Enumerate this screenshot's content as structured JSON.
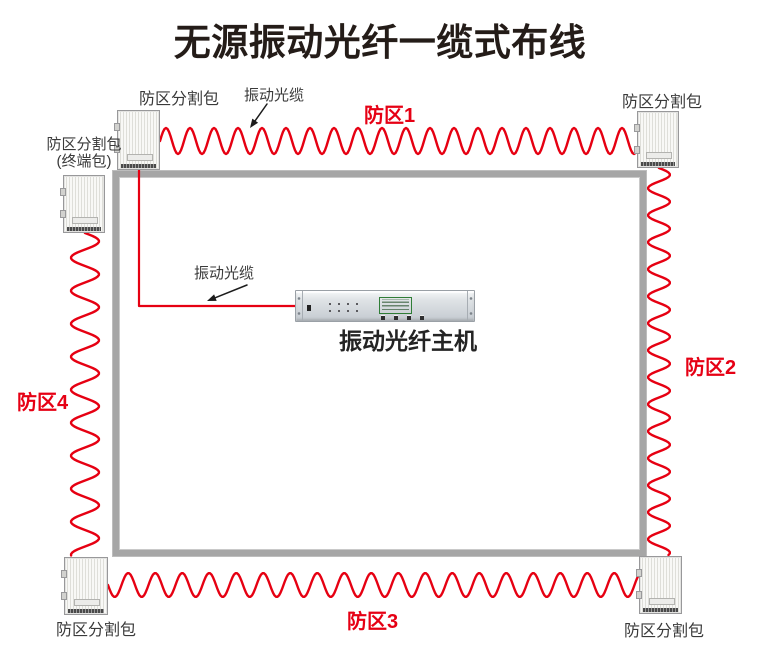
{
  "title": "无源振动光纤一缆式布线",
  "colors": {
    "cable": "#e60012",
    "wall": "#a6a6a6",
    "zone_label": "#e60014",
    "arrow": "#1c1c1c",
    "lcd_green": "#4ce05a"
  },
  "labels": {
    "splitter": "防区分割包",
    "terminal_splitter_line1": "防区分割包",
    "terminal_splitter_line2": "(终端包)",
    "vibration_cable": "振动光缆",
    "host": "振动光纤主机"
  },
  "zones": [
    {
      "label": "防区1"
    },
    {
      "label": "防区2"
    },
    {
      "label": "防区3"
    },
    {
      "label": "防区4"
    }
  ]
}
